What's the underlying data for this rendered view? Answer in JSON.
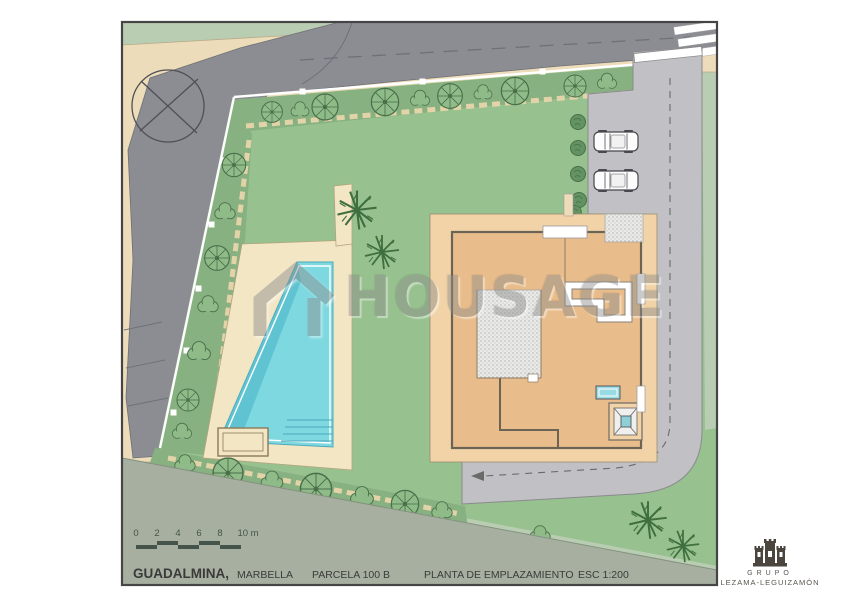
{
  "watermark": {
    "brand": "HOUSAGE"
  },
  "scale_bar": {
    "labels": [
      "0",
      "2",
      "4",
      "6",
      "8",
      "10 m"
    ]
  },
  "title_block": {
    "location": "GUADALMINA,",
    "city": "MARBELLA",
    "parcel": "PARCELA 100 B",
    "drawing_title": "PLANTA DE EMPLAZAMIENTO",
    "scale": "ESC 1:200"
  },
  "branding": {
    "group": "GRUPO",
    "name": "LEZAMA-LEGUIZAMÓN"
  },
  "colors": {
    "outer": "#b9cdb2",
    "band": "#a7b0a0",
    "lawn": "#97c18e",
    "hedge": "#88b181",
    "road": "#8c8c93",
    "driveway": "#c1c1c5",
    "sidewalk": "#eddcb9",
    "terrace": "#f3e6c5",
    "pool": "#7ed8e0",
    "pooldark": "#4fb9c9",
    "apron": "#f1d3a7",
    "core": "#e9bd8b",
    "walldark": "#6b6356",
    "stipple": "#e9e9e7",
    "treefill": "#8fbb88",
    "treestroke": "#4a6f4a",
    "palm": "#3f6f3f",
    "bush": "#639363",
    "marking": "#70707a",
    "textdark": "#3a3a3a",
    "scaletext": "#45544a",
    "frame": "#454545",
    "watermark": "#8c8c8c"
  }
}
